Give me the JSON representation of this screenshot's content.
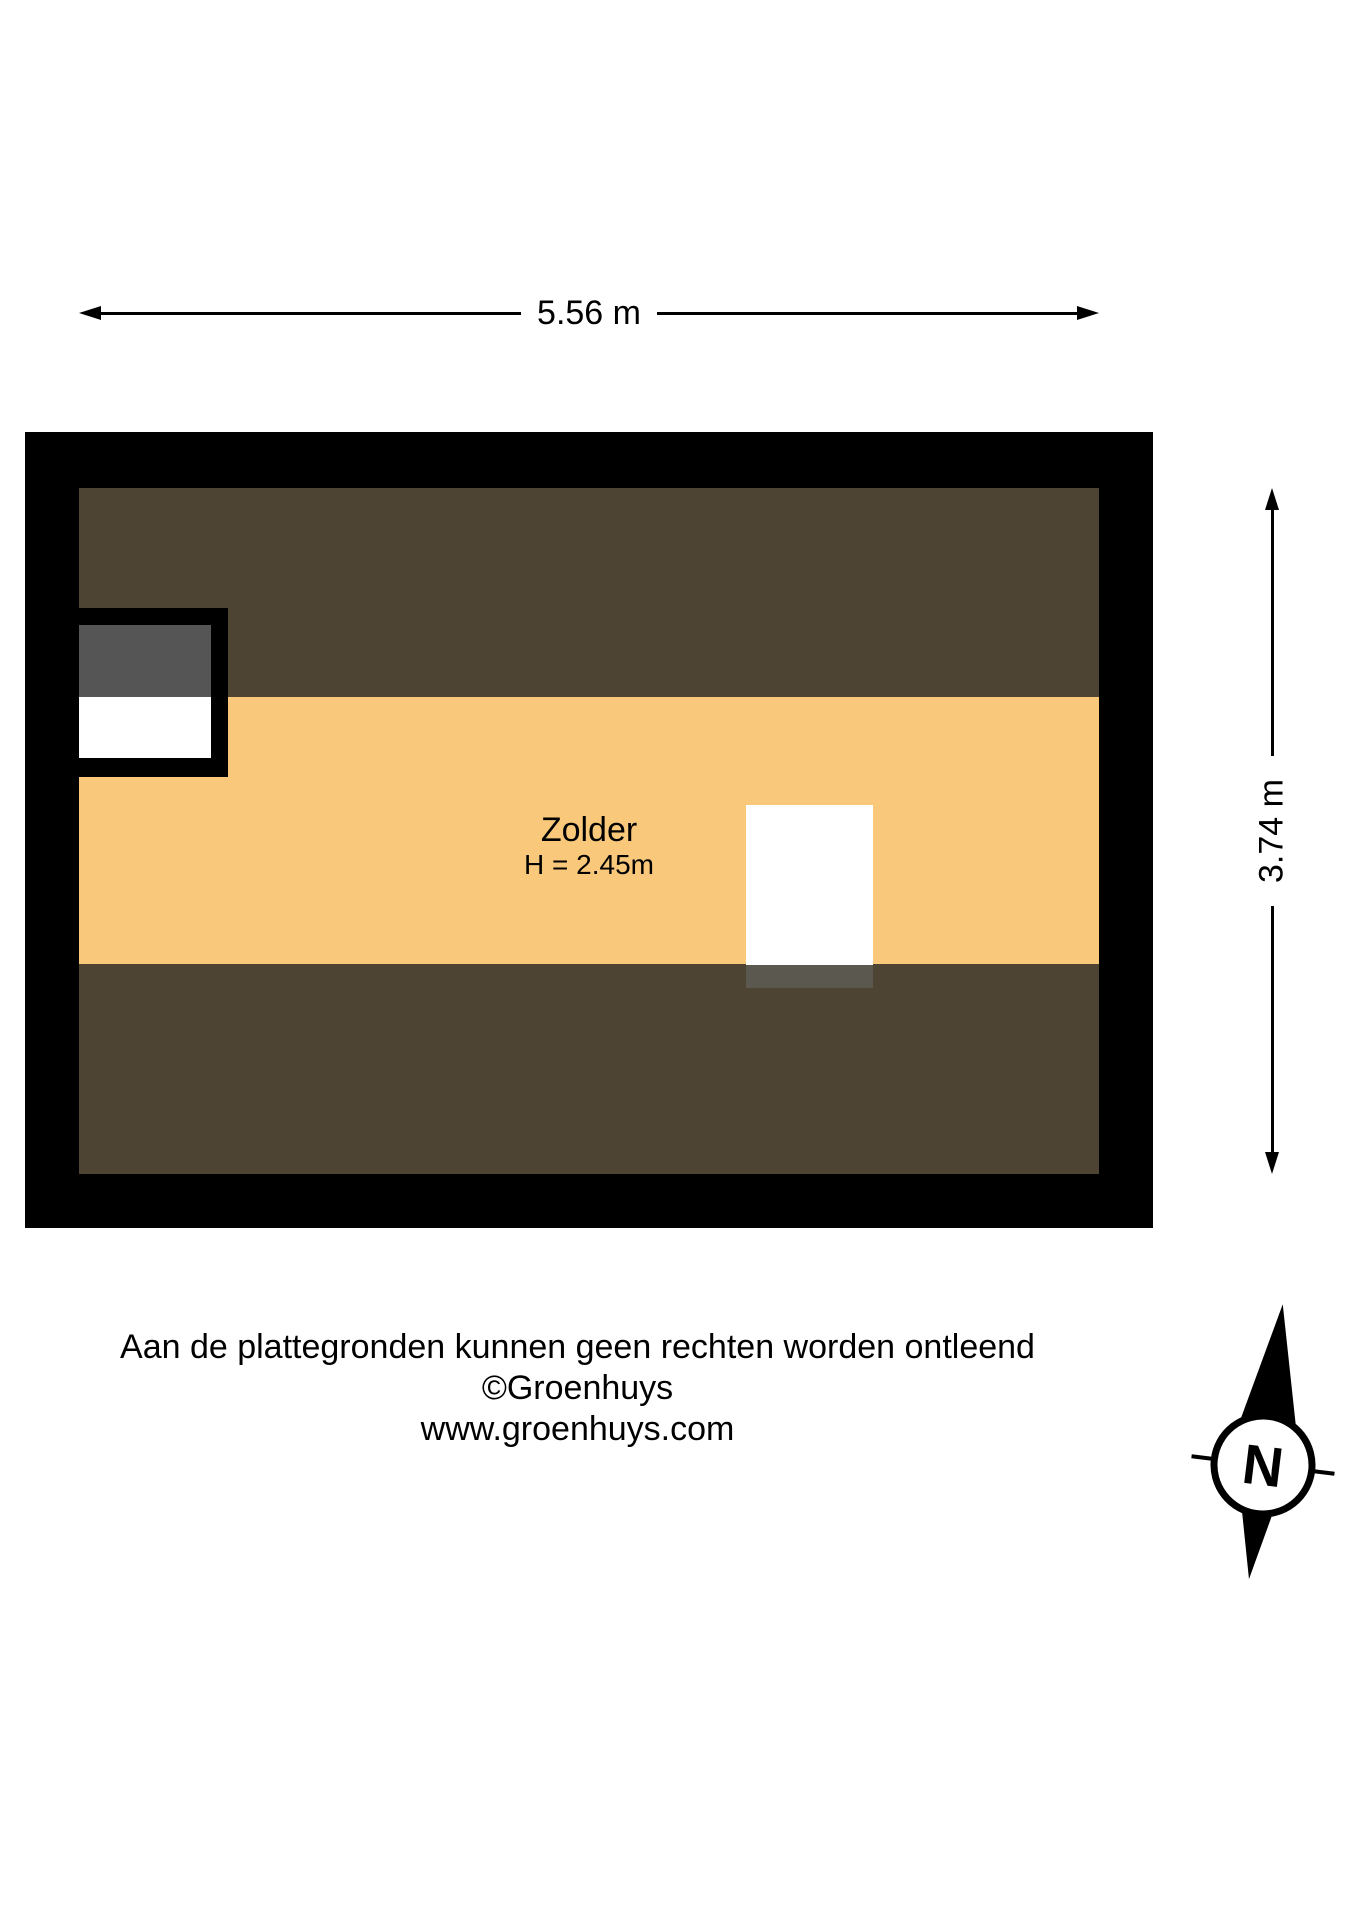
{
  "dimensions": {
    "width_label": "5.56 m",
    "height_label": "3.74 m"
  },
  "room": {
    "name": "Zolder",
    "height_label": "H = 2.45m"
  },
  "footer": {
    "line1": "Aan de plattegronden kunnen geen rechten worden ontleend",
    "line2": "©Groenhuys",
    "line3": "www.groenhuys.com"
  },
  "compass": {
    "north_label": "N"
  },
  "colors": {
    "background": "#ffffff",
    "wall": "#000000",
    "floor": "#fac87a",
    "roof_slope": "#4d4434",
    "closet_shade": "#555555",
    "stair_shade": "#5b5850"
  }
}
